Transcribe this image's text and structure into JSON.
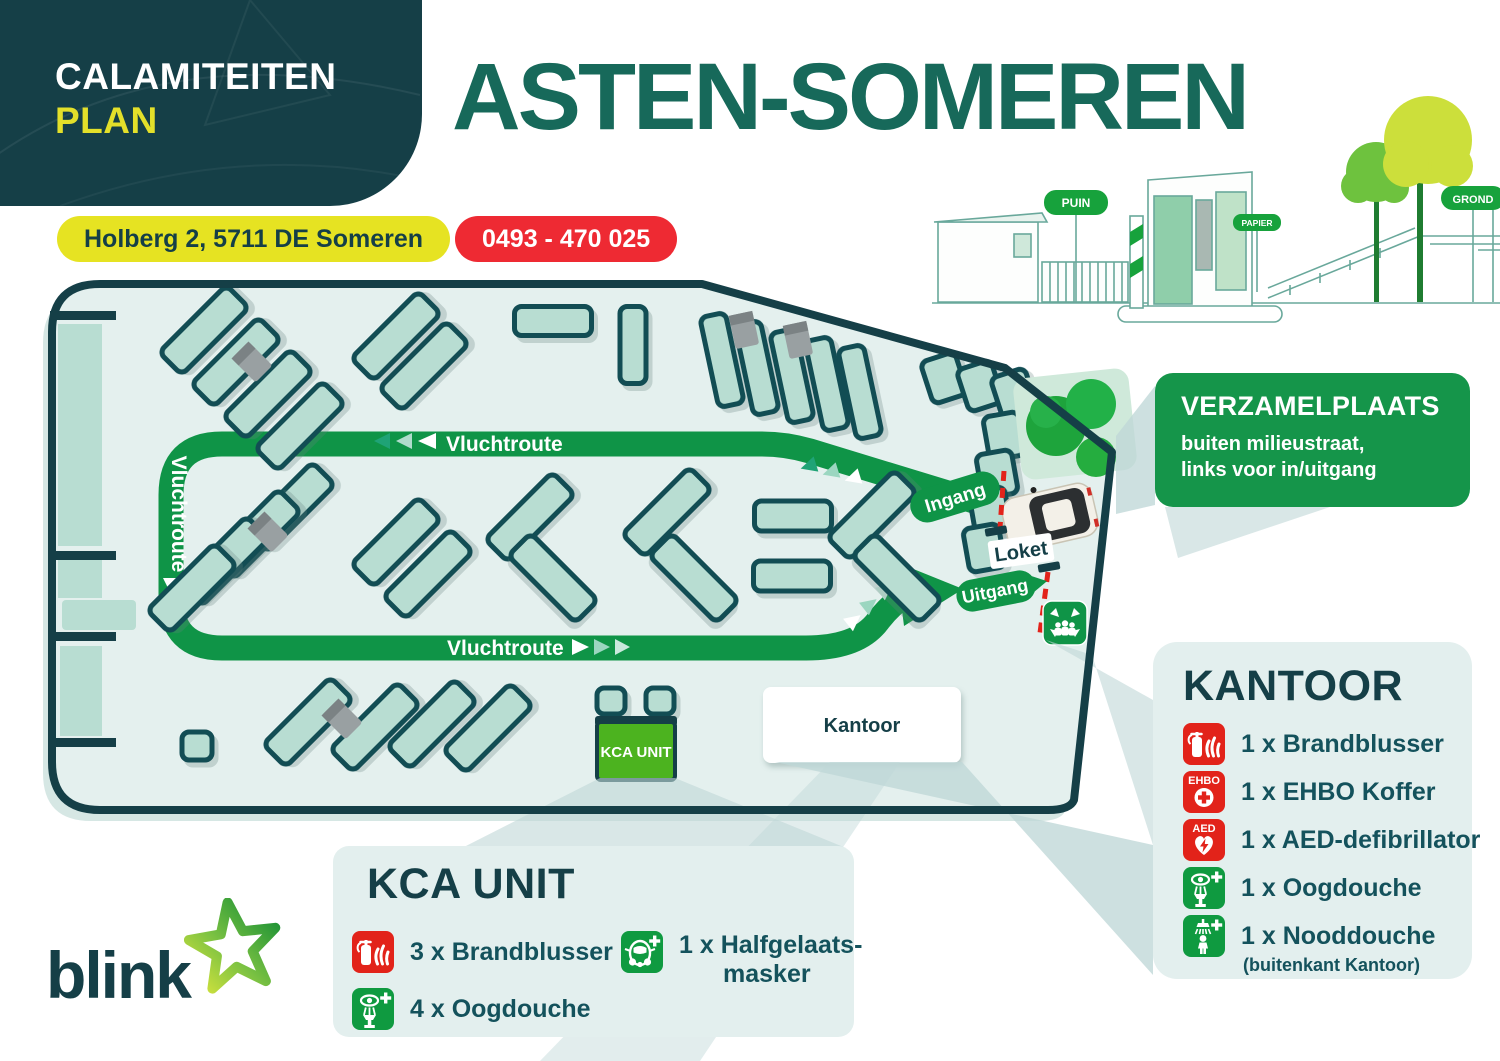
{
  "header": {
    "line1": "CALAMITEITEN",
    "line2": "PLAN",
    "title": "ASTEN-SOMEREN",
    "address": "Holberg 2, 5711 DE Someren",
    "phone": "0493 - 470 025"
  },
  "illustration": {
    "sign_puin": "PUIN",
    "sign_papier": "PAPIER",
    "sign_grond": "GROND"
  },
  "map": {
    "route_label": "Vluchtroute",
    "ingang_label": "Ingang",
    "uitgang_label": "Uitgang",
    "loket_label": "Loket",
    "kantoor_label": "Kantoor",
    "kca_label": "KCA UNIT"
  },
  "icon_texts": {
    "ehbo": "EHBO",
    "aed": "AED"
  },
  "verzamelplaats": {
    "title": "VERZAMELPLAATS",
    "line1": "buiten milieustraat,",
    "line2": "links voor in/uitgang"
  },
  "kantoor_panel": {
    "title": "KANTOOR",
    "items": [
      {
        "label": "1 x Brandblusser"
      },
      {
        "label": "1 x EHBO Koffer"
      },
      {
        "label": "1 x AED-defibrillator"
      },
      {
        "label": "1 x Oogdouche"
      },
      {
        "label": "1 x Nooddouche",
        "note": "(buitenkant Kantoor)"
      }
    ]
  },
  "kca_panel": {
    "title": "KCA UNIT",
    "items": [
      {
        "label": "3 x Brandblusser"
      },
      {
        "label": "4 x Oogdouche"
      },
      {
        "label": "1 x Halfgelaats-",
        "label2": "masker"
      }
    ]
  },
  "logo": {
    "text": "blink"
  },
  "colors": {
    "dark_teal": "#153f47",
    "title_green": "#17695a",
    "route_green": "#0f9447",
    "accent_yellow": "#e6e322",
    "accent_red": "#ee2a33",
    "panel_bg": "#e3efee",
    "map_bg": "#e4f0ee",
    "container_fill": "#b8ddd2",
    "bright_green": "#4cb31f",
    "pictogram_green": "#0f9a40",
    "pictogram_red": "#e2231a"
  }
}
